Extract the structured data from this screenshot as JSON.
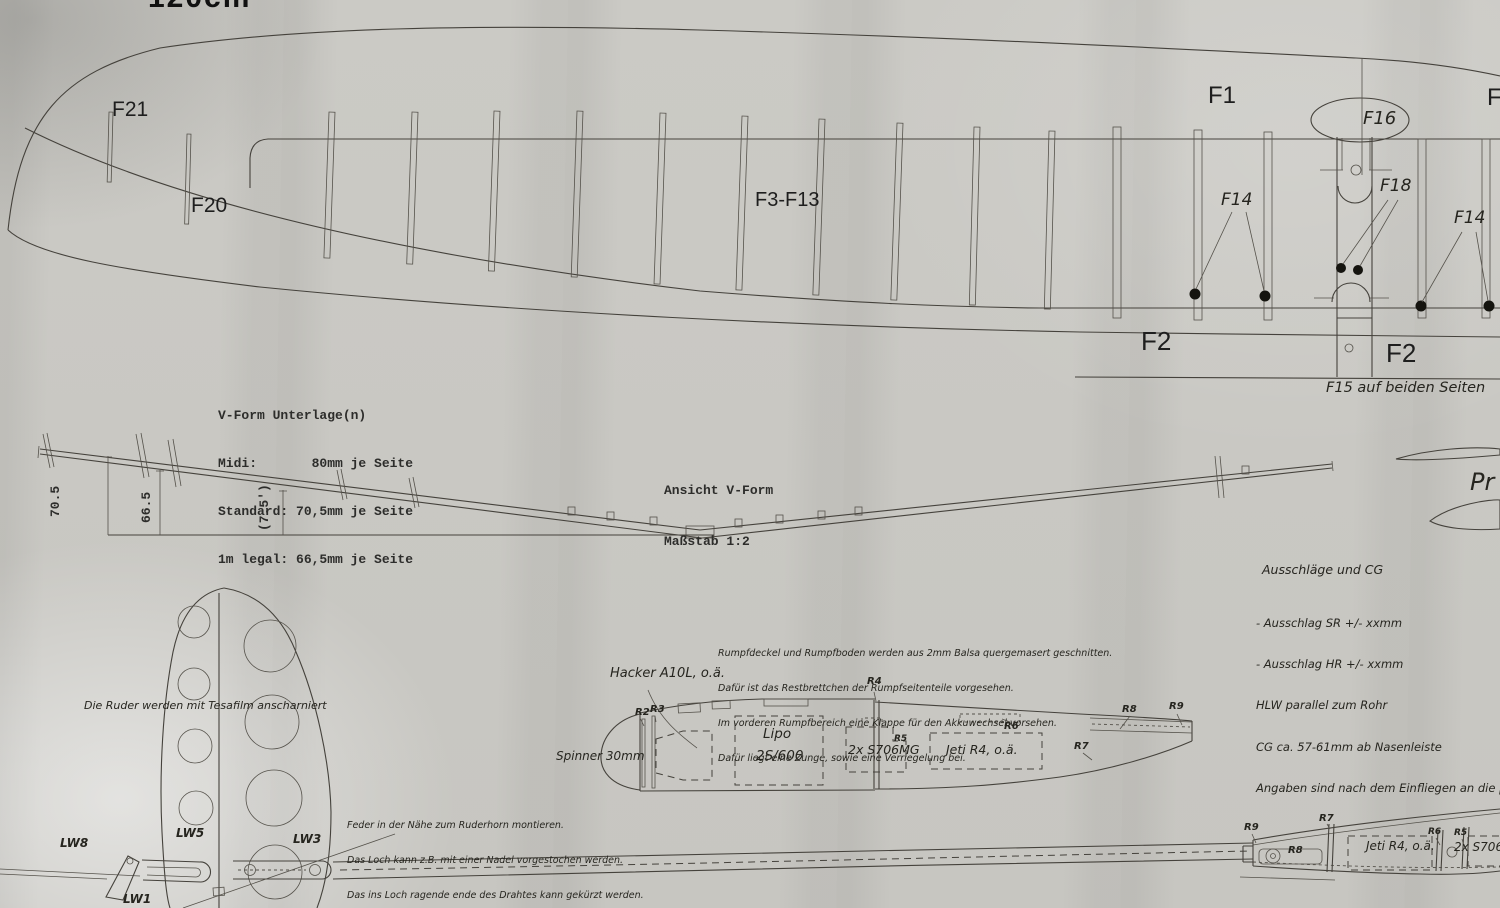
{
  "title_partial": "120cm",
  "wing_plan": {
    "f21": "F21",
    "f20": "F20",
    "f3_f13": "F3-F13",
    "f1": "F1",
    "f1_right_partial": "F1",
    "f16": "F16",
    "f18": "F18",
    "f14_left": "F14",
    "f14_right": "F14",
    "f2_left": "F2",
    "f2_right": "F2",
    "f15_note": "F15 auf beiden Seiten"
  },
  "vform_table": {
    "title": "V-Form Unterlage(n)",
    "rows": [
      "Midi:       80mm je Seite",
      "Standard: 70,5mm je Seite",
      "1m legal: 66,5mm je Seite"
    ]
  },
  "vform_view": {
    "label_line1": "Ansicht V-Form",
    "label_line2": "Maßstab 1:2",
    "dim_70_5": "70.5",
    "dim_66_5": "66.5",
    "dim_7_5": "(7.5')"
  },
  "profile_partial": "Pr",
  "cg_notes": {
    "title": "Ausschläge und CG",
    "lines": [
      "- Ausschlag SR +/- xxmm",
      "- Ausschlag HR +/- xxmm",
      "HLW parallel zum Rohr",
      "CG ca. 57-61mm ab Nasenleiste",
      "Angaben sind nach dem Einfliegen an die persönlichen W"
    ]
  },
  "fin": {
    "hinge_note": "Die Ruder werden mit Tesafilm anscharniert",
    "lw8": "LW8",
    "lw5": "LW5",
    "lw3": "LW3",
    "lw1": "LW1"
  },
  "feder_notes": [
    "Feder in der Nähe zum Ruderhorn montieren.",
    "Das Loch kann z.B. mit einer Nadel vorgestochen werden.",
    "Das ins Loch ragende ende des Drahtes kann gekürzt werden.",
    "Die Federn werden nach dem Bespannen eingesteckt, müssen jedoch nicht unbedingt verklebt werden"
  ],
  "fuselage_notes": [
    "Rumpfdeckel und Rumpfboden werden aus 2mm Balsa quergemasert geschnitten.",
    "Dafür ist das Restbrettchen der Rumpfseitenteile vorgesehen.",
    "Im vorderen Rumpfbereich eine Klappe für den Akkuwechsel vorsehen.",
    "Dafür liegt eine Zunge, sowie eine Verriegelung bei."
  ],
  "fuselage_top": {
    "motor": "Hacker A10L, o.ä.",
    "spinner": "Spinner 30mm",
    "battery1": "Lipo",
    "battery2": "2S/600",
    "servos": "2x S706MG",
    "receiver": "Jeti R4, o.ä.",
    "r2": "R2",
    "r3": "R3",
    "r4": "R4",
    "r5": "R5",
    "r6": "R6",
    "r7": "R7",
    "r8": "R8",
    "r9": "R9"
  },
  "fuselage_side": {
    "receiver": "Jeti R4, o.ä.",
    "servos_partial": "2x S706M",
    "r9": "R9",
    "r7": "R7",
    "r8": "R8",
    "r6": "R6",
    "r5": "R5"
  }
}
